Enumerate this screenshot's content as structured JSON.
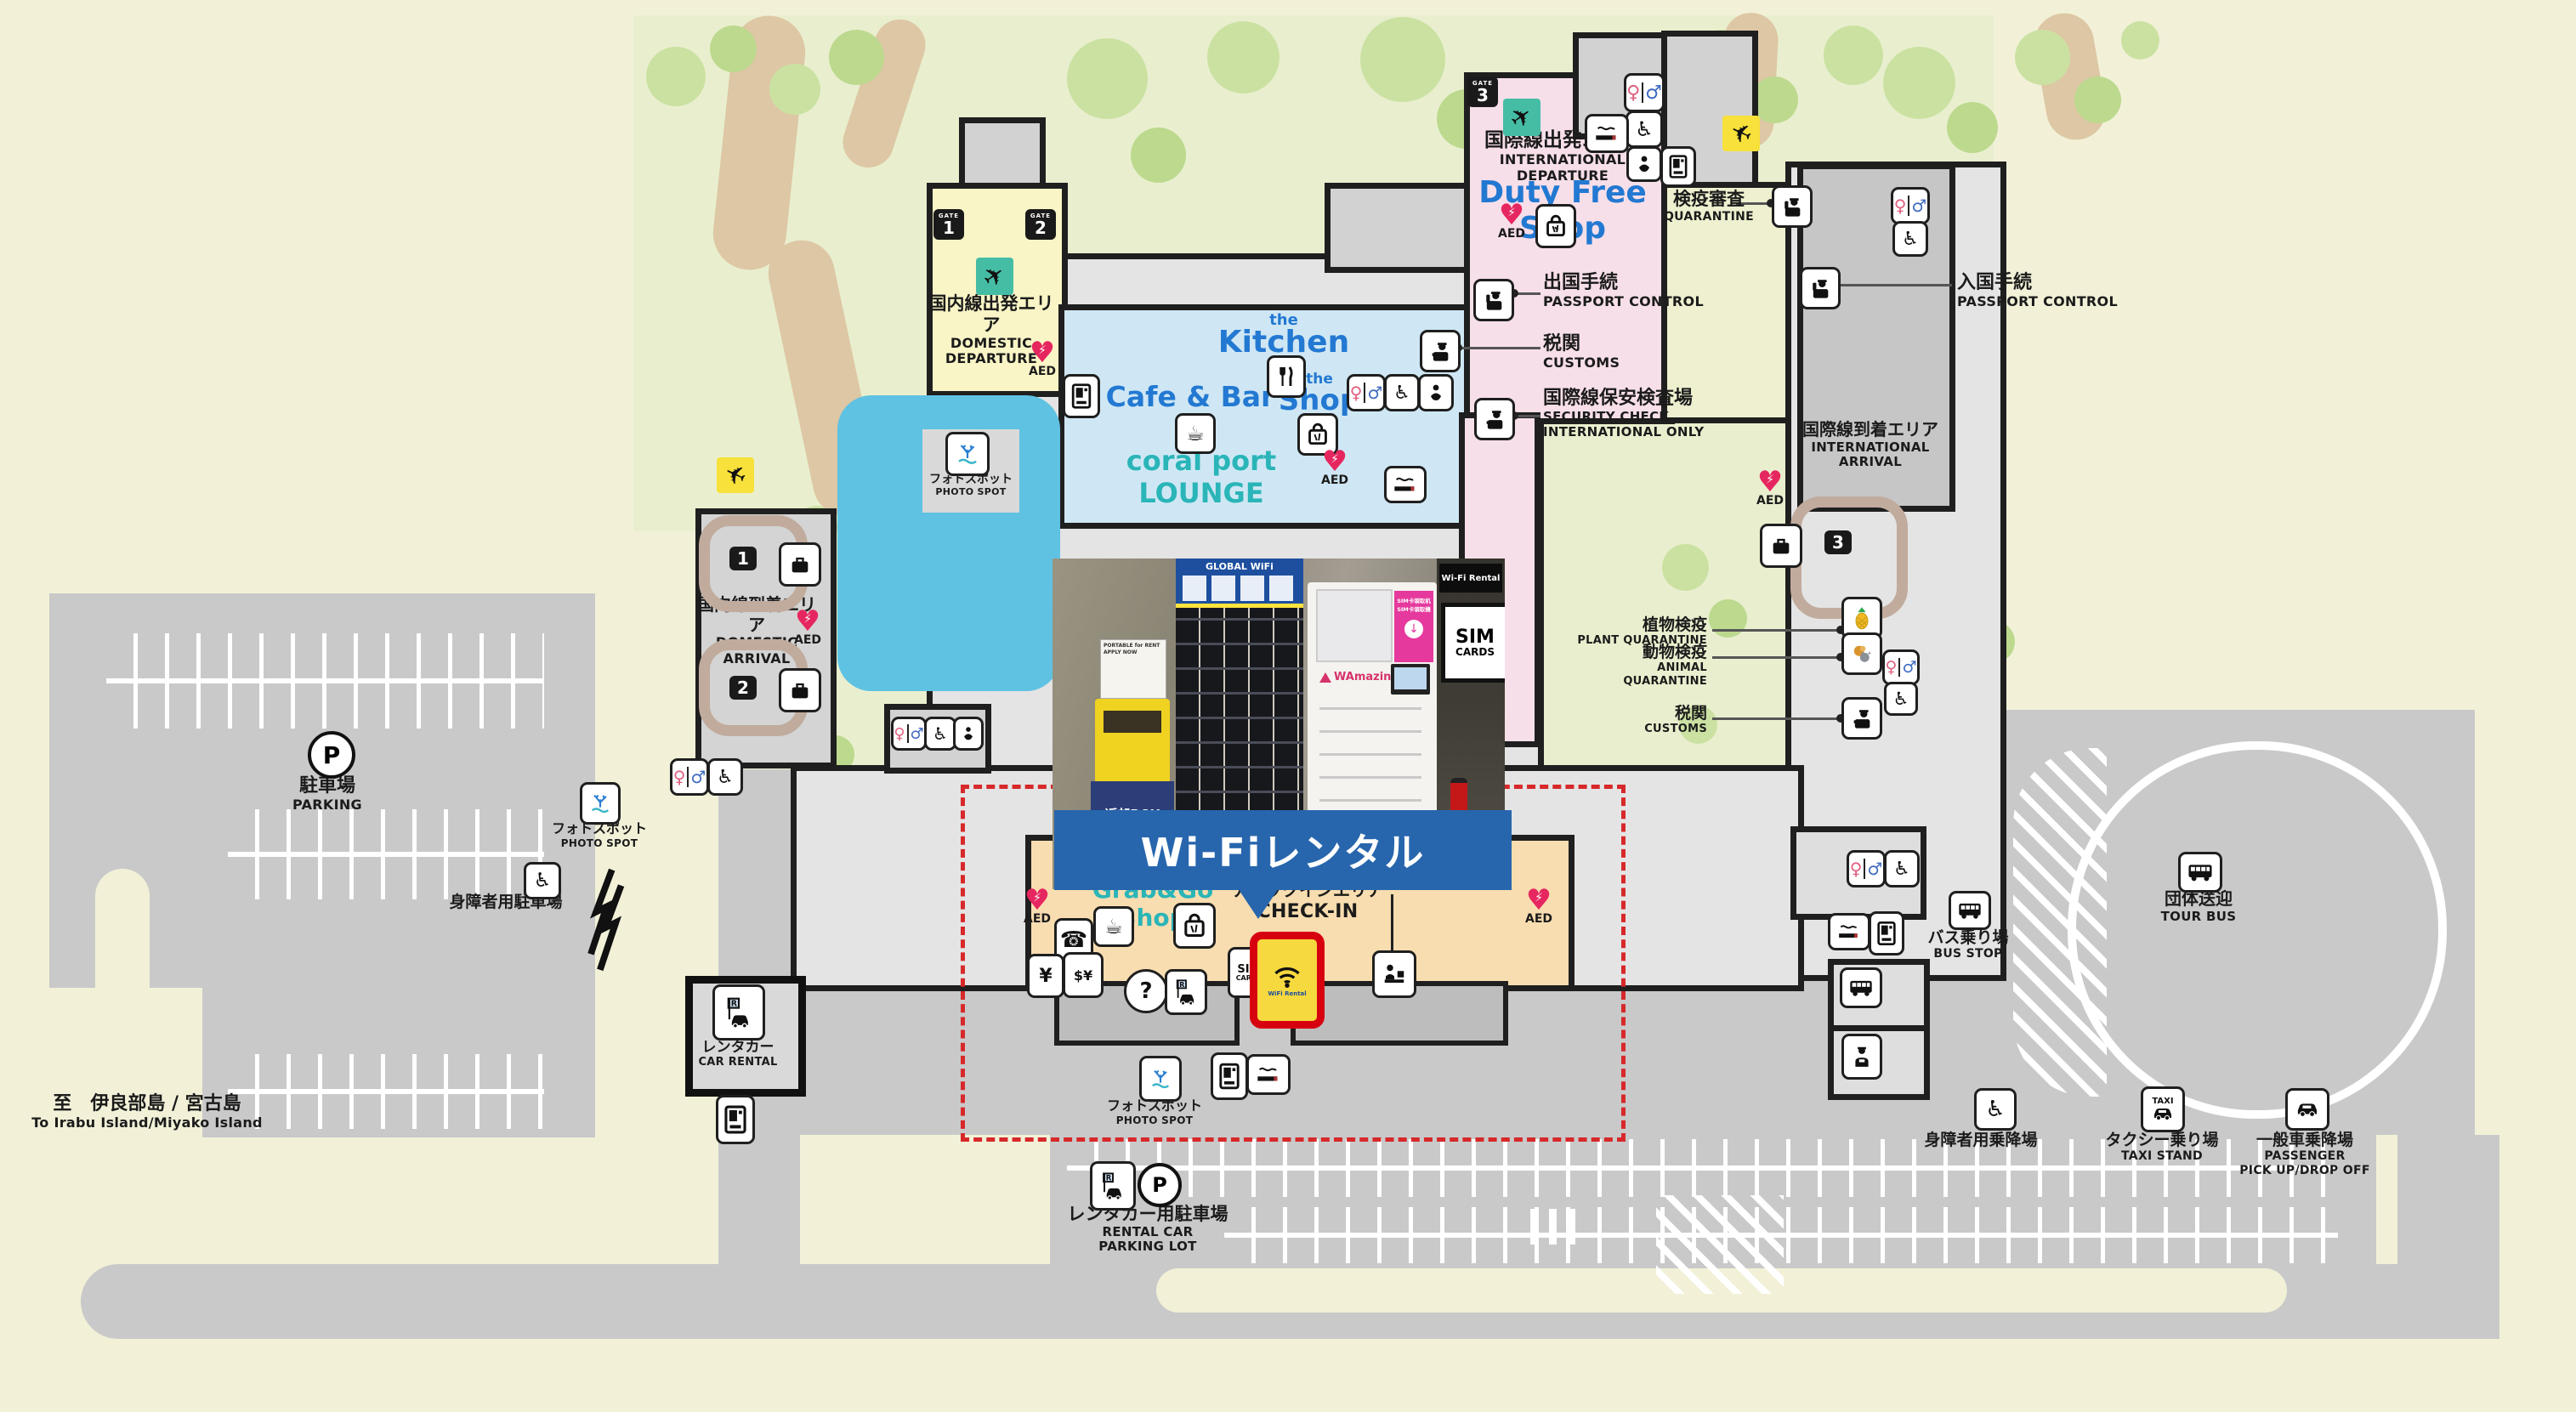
{
  "banner": {
    "text": "Wi-Fiレンタル"
  },
  "labels": {
    "domestic_departure": {
      "jp": "国内線出発エリア",
      "en": "DOMESTIC DEPARTURE"
    },
    "international_departure": {
      "jp": "国際線出発エリア",
      "en": "INTERNATIONAL DEPARTURE"
    },
    "duty_free": {
      "text": "Duty Free Shop"
    },
    "quarantine": {
      "jp": "検疫審査",
      "en": "QUARANTINE"
    },
    "passport_control_arrival": {
      "jp": "入国手続",
      "en": "PASSPORT CONTROL"
    },
    "passport_control_departure": {
      "jp": "出国手続",
      "en": "PASSPORT CONTROL"
    },
    "customs_departure": {
      "jp": "税関",
      "en": "CUSTOMS"
    },
    "security_check": {
      "jp": "国際線保安検査場",
      "en1": "SECURITY CHECK",
      "en2": "INTERNATIONAL ONLY"
    },
    "international_arrival": {
      "jp": "国際線到着エリア",
      "en": "INTERNATIONAL ARRIVAL"
    },
    "plant_quarantine": {
      "jp": "植物検疫",
      "en": "PLANT QUARANTINE"
    },
    "animal_quarantine": {
      "jp": "動物検疫",
      "en": "ANIMAL QUARANTINE"
    },
    "customs_arrival": {
      "jp": "税関",
      "en": "CUSTOMS"
    },
    "the_kitchen": {
      "the": "the",
      "name": "Kitchen"
    },
    "cafe_bar": {
      "text": "Cafe & Bar"
    },
    "the_shop": {
      "the": "the",
      "name": "Shop"
    },
    "lounge": {
      "text": "coral port  LOUNGE"
    },
    "domestic_arrival": {
      "jp": "国内線到着エリア",
      "en": "DOMESTIC ARRIVAL"
    },
    "photo_spot": {
      "jp": "フォトスポット",
      "en": "PHOTO SPOT"
    },
    "parking": {
      "jp": "駐車場",
      "en": "PARKING"
    },
    "disabled_parking": {
      "jp": "身障者用駐車場"
    },
    "car_rental": {
      "jp": "レンタカー",
      "en": "CAR RENTAL"
    },
    "grab_go": {
      "text": "Grab&Go  Shop"
    },
    "checkin": {
      "jp": "チェックインエリア",
      "en": "CHECK-IN"
    },
    "rental_parking": {
      "jp": "レンタカー用駐車場",
      "en1": "RENTAL CAR",
      "en2": "PARKING LOT"
    },
    "to_islands": {
      "jp": "至　伊良部島 / 宮古島",
      "en": "To Irabu Island/Miyako Island"
    },
    "bus_stop": {
      "jp": "バス乗り場",
      "en": "BUS STOP"
    },
    "tour_bus": {
      "jp": "団体送迎",
      "en": "TOUR BUS"
    },
    "disabled_pickup": {
      "jp": "身障者用乗降場"
    },
    "taxi_stand": {
      "jp": "タクシー乗り場",
      "en": "TAXI STAND"
    },
    "passenger": {
      "jp": "一般車乗降場",
      "en1": "PASSENGER",
      "en2": "PICK UP/DROP OFF"
    }
  },
  "gates": {
    "label": "GATE",
    "g1": "1",
    "g2": "2",
    "g3": "3"
  },
  "aed": {
    "text": "AED"
  },
  "photo": {
    "wifi_rental": "Wi-Fi Rental",
    "sim": "SIM",
    "cards": "CARDS",
    "global_wifi": "GLOBAL WiFi",
    "portable": "PORTABLE for RENT APPLY NOW",
    "return_jp": "返却BOX",
    "return_en": "Return",
    "sim_machine_1": "SIM卡領取机",
    "sim_machine_2": "SIM卡領取機",
    "wamazing": "WAmazing",
    "extinguisher": "消火器"
  },
  "icons": {
    "female": "♀",
    "male": "♂",
    "wheelchair": "♿",
    "phone": "☎",
    "coffee": "☕",
    "plane": "✈",
    "question": "?",
    "atm": "¥",
    "exchange": "$¥",
    "p": "P",
    "taxi": "TAXI",
    "sim1": "SIM",
    "sim2": "CARDS",
    "wifi_small": "WiFi Rental",
    "heart": "♥",
    "bolt": "⚡"
  },
  "colors": {
    "banner_blue": "#2766ad",
    "highlight_red": "#d7000f",
    "accent_teal": "#2ab5b8",
    "accent_blue": "#2379d2",
    "area_pink": "#f7dfe9",
    "area_yellow": "#f9f5c6",
    "area_peach": "#f8ddb0",
    "lounge_blue": "#cfe7f4",
    "pool_blue": "#5fc2e2"
  }
}
